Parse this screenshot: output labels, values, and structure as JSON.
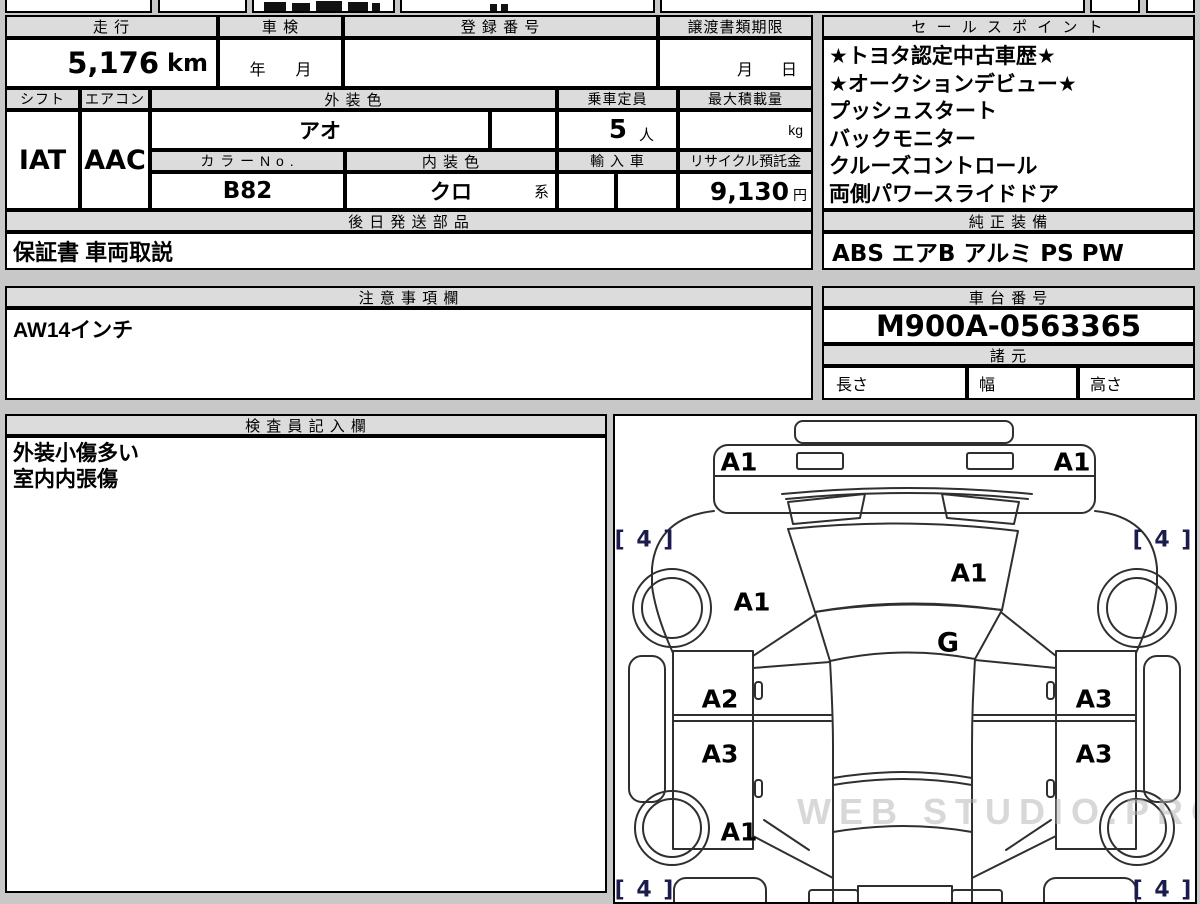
{
  "top_table": {
    "headers": {
      "mileage": "走 行",
      "inspection": "車 検",
      "registration": "登 録 番 号",
      "transfer_deadline": "譲渡書類期限"
    },
    "values": {
      "mileage": "5,176",
      "mileage_unit": "km",
      "inspection_year": "年",
      "inspection_month": "月",
      "transfer_month": "月",
      "transfer_day": "日"
    }
  },
  "spec_table": {
    "headers": {
      "shift": "シフト",
      "aircon": "エアコン",
      "exterior_color": "外 装 色",
      "capacity": "乗車定員",
      "max_load": "最大積載量",
      "color_no": "カ ラ ー N o .",
      "interior_color": "内 装 色",
      "import": "輸 入 車",
      "recycle_deposit": "リサイクル預託金"
    },
    "values": {
      "shift": "IAT",
      "aircon": "AAC",
      "exterior_color": "アオ",
      "capacity": "5",
      "capacity_unit": "人",
      "max_load_unit": "kg",
      "color_no": "B82",
      "interior_color": "クロ",
      "interior_suffix": "系",
      "recycle_deposit": "9,130",
      "recycle_unit": "円"
    }
  },
  "later_parts": {
    "header": "後 日 発 送 部 品",
    "value": "保証書 車両取説"
  },
  "sales_points": {
    "header": "セ ー ル ス ポ イ ン ト",
    "lines": [
      "★トヨタ認定中古車歴★",
      "★オークションデビュー★",
      "プッシュスタート",
      "バックモニター",
      "クルーズコントロール",
      "両側パワースライドドア"
    ]
  },
  "oem_equipment": {
    "header": "純 正 装 備",
    "value": "ABS エアB アルミ PS PW"
  },
  "notes": {
    "header": "注 意 事 項 欄",
    "value": "AW14インチ"
  },
  "chassis": {
    "header": "車 台 番 号",
    "value": "M900A-0563365",
    "spec_header": "諸 元",
    "dim_length": "長さ",
    "dim_width": "幅",
    "dim_height": "高さ"
  },
  "inspector": {
    "header": "検 査 員 記 入 欄",
    "lines": [
      "外装小傷多い",
      "室内内張傷"
    ]
  },
  "diagram": {
    "labels": {
      "front_left": "A1",
      "front_right": "A1",
      "hood_left": "A1",
      "hood_right": "A1",
      "glass": "G",
      "door_front_left": "A2",
      "door_rear_left": "A3",
      "door_front_right": "A3",
      "door_rear_right": "A3",
      "rear_left": "A1",
      "tire_front_left": "[ 4 ]",
      "tire_front_right": "[ 4 ]",
      "tire_rear_left": "[ 4 ]",
      "tire_rear_right": "[ 4 ]"
    },
    "watermark": "WEB STUDIO.PRO"
  }
}
